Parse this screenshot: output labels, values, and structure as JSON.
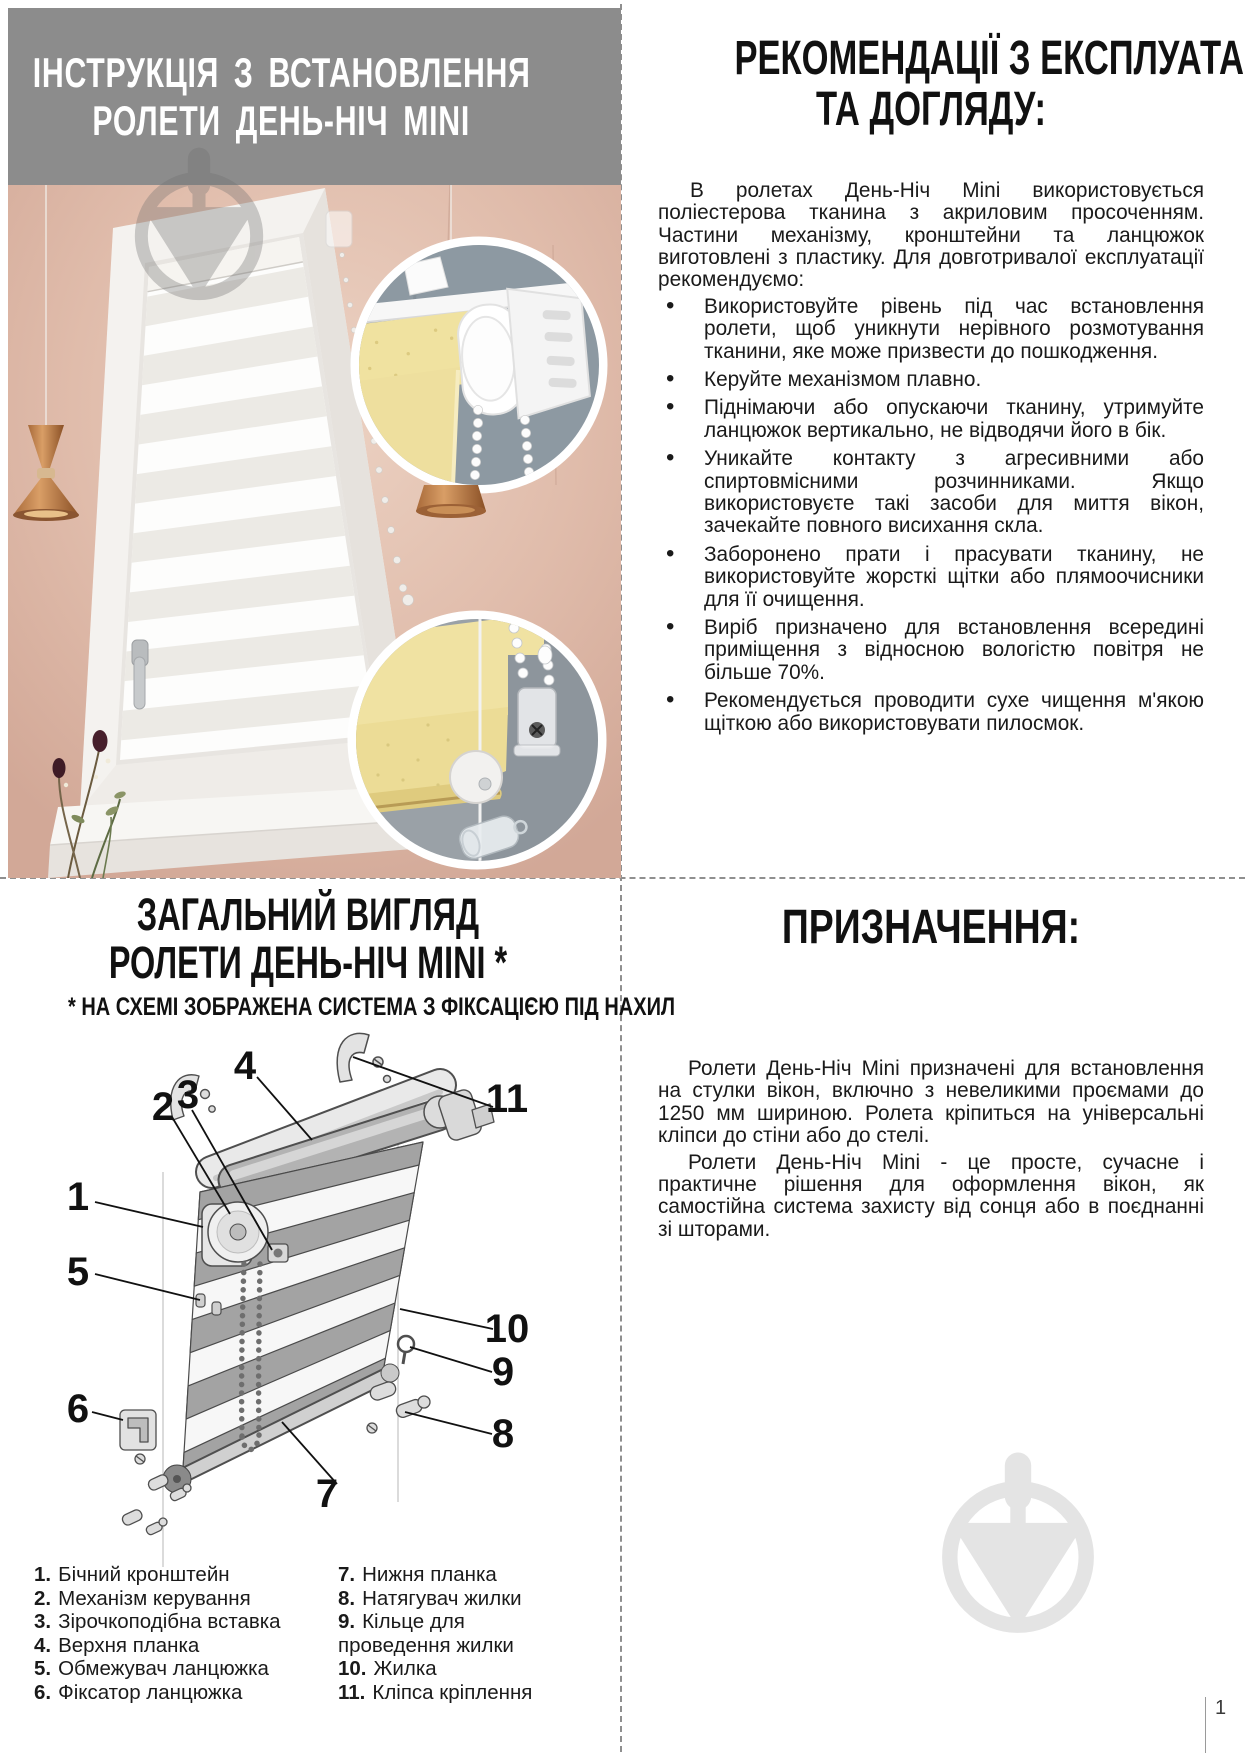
{
  "page": {
    "number": "1"
  },
  "top_left": {
    "title_line1": "ІНСТРУКЦІЯ З ВСТАНОВЛЕННЯ",
    "title_line2": "РОЛЕТИ ДЕНЬ-НІЧ MINI"
  },
  "top_right": {
    "title_line1": "РЕКОМЕНДАЦІЇ З ЕКСПЛУАТАЦІЇ",
    "title_line2": "ТА ДОГЛЯДУ:",
    "intro": "В ролетах День-Ніч Mini використовується поліестерова тканина з акриловим просоченням. Частини механізму, кронштейни та ланцюжок виготовлені з пластику. Для довготривалої експлуатації рекомендуємо:",
    "bullets": [
      "Використовуйте рівень під час встановлення ролети, щоб уникнути нерівного розмотування тканини, яке може призвести до пошкодження.",
      "Керуйте механізмом плавно.",
      "Піднімаючи або опускаючи тканину, утримуйте ланцюжок вертикально, не відводячи його в бік.",
      "Уникайте контакту з агресивними або спиртовмісними розчинниками. Якщо використовуєте такі засоби для миття вікон, зачекайте повного висихання скла.",
      "Заборонено прати і прасувати тканину, не використовуйте жорсткі щітки або плямоочисники для її очищення.",
      "Виріб призначено для встановлення всередині приміщення з відносною вологістю повітря не більше 70%.",
      "Рекомендується проводити сухе чищення м'якою щіткою або використовувати пилосмок."
    ]
  },
  "bottom_left": {
    "title_line1": "ЗАГАЛЬНИЙ ВИГЛЯД",
    "title_line2": "РОЛЕТИ ДЕНЬ-НІЧ MINI *",
    "subtitle": "* НА СХЕМІ ЗОБРАЖЕНА СИСТЕМА З ФІКСАЦІЄЮ ПІД НАХИЛ",
    "callouts": [
      "1",
      "2",
      "3",
      "4",
      "5",
      "6",
      "7",
      "8",
      "9",
      "10",
      "11"
    ],
    "parts_col1": [
      {
        "num": "1.",
        "label": "Бічний кронштейн"
      },
      {
        "num": "2.",
        "label": "Механізм керування"
      },
      {
        "num": "3.",
        "label": "Зірочкоподібна вставка"
      },
      {
        "num": "4.",
        "label": "Верхня планка"
      },
      {
        "num": "5.",
        "label": "Обмежувач ланцюжка"
      },
      {
        "num": "6.",
        "label": "Фіксатор ланцюжка"
      }
    ],
    "parts_col2": [
      {
        "num": "7.",
        "label": "Нижня планка"
      },
      {
        "num": "8.",
        "label": "Натягувач жилки"
      },
      {
        "num": "9.",
        "label": "Кільце для проведення жилки"
      },
      {
        "num": "10.",
        "label": "Жилка"
      },
      {
        "num": "11.",
        "label": "Кліпса кріплення"
      }
    ]
  },
  "bottom_right": {
    "title": "ПРИЗНАЧЕННЯ:",
    "paragraphs": [
      "Ролети День-Ніч Mini призначені для встановлення на стулки вікон, включно з невеликими проємами до 1250 мм шириною. Ролета кріпиться на універсальні кліпси до стіни або до стелі.",
      "Ролети День-Ніч Mini - це просте, сучасне і практичне рішення для оформлення вікон, як самостійна система захисту від сонця або в поєднанні зі шторами."
    ]
  },
  "colors": {
    "header_gray": "#8c8c8c",
    "wall_pink": "#d7b0a2",
    "fabric_yellow": "#f0e2a0",
    "copper": "#c08050",
    "inset_bg": "#8d99a2",
    "watermark_gray": "#e4e4e4"
  }
}
